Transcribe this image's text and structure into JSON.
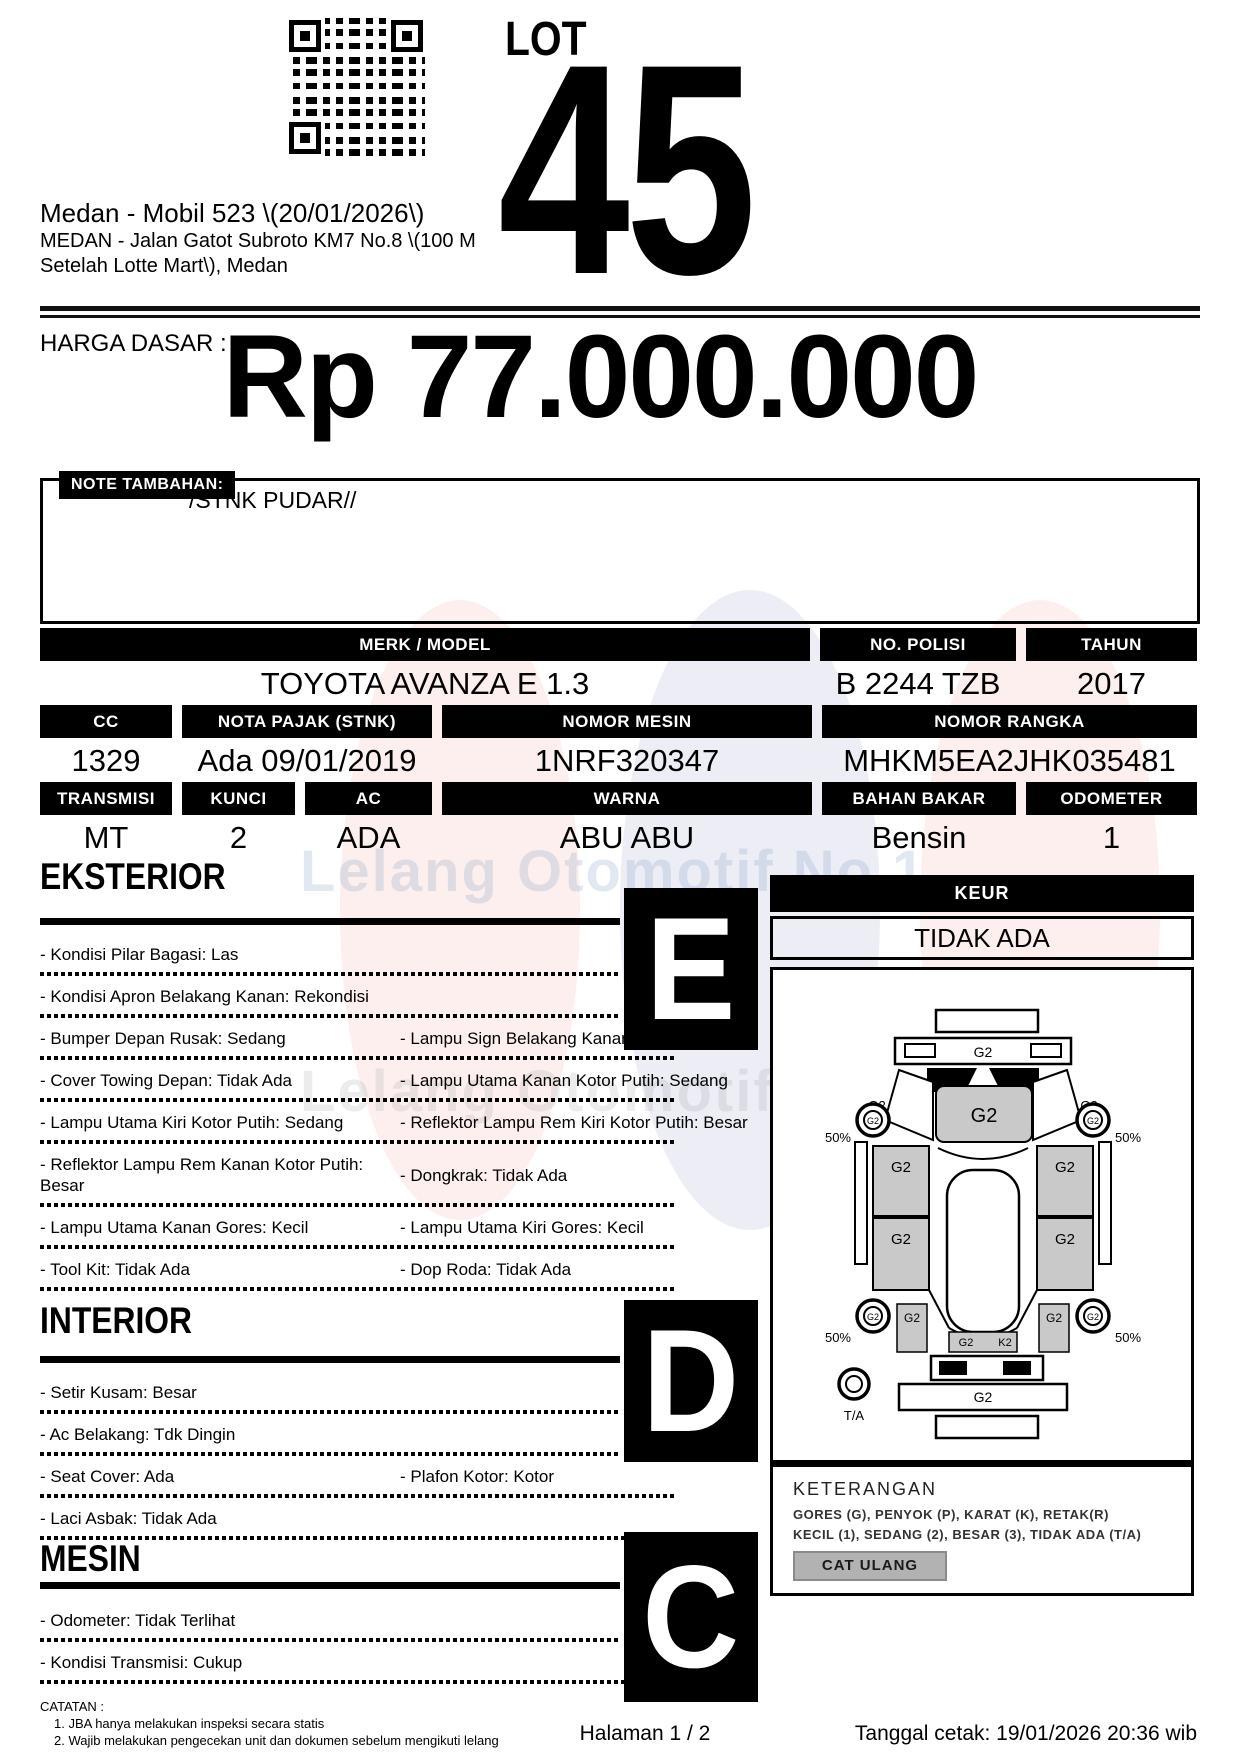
{
  "header": {
    "lot_label": "LOT",
    "lot_number": "45",
    "title": "Medan - Mobil 523 \\(20/01/2026\\)",
    "address_line1": "MEDAN - Jalan Gatot Subroto KM7 No.8 \\(100 M",
    "address_line2": "Setelah Lotte Mart\\), Medan"
  },
  "price": {
    "label": "HARGA DASAR :",
    "value": "Rp 77.000.000"
  },
  "note": {
    "label": "NOTE TAMBAHAN:",
    "text": "/STNK PUDAR//"
  },
  "specs": {
    "row1": [
      {
        "label": "MERK / MODEL",
        "value": "TOYOTA AVANZA E 1.3"
      },
      {
        "label": "NO. POLISI",
        "value": "B 2244 TZB"
      },
      {
        "label": "TAHUN",
        "value": "2017"
      }
    ],
    "row2": [
      {
        "label": "CC",
        "value": "1329"
      },
      {
        "label": "NOTA PAJAK (STNK)",
        "value": "Ada 09/01/2019"
      },
      {
        "label": "NOMOR MESIN",
        "value": "1NRF320347"
      },
      {
        "label": "NOMOR RANGKA",
        "value": "MHKM5EA2JHK035481"
      }
    ],
    "row3": [
      {
        "label": "TRANSMISI",
        "value": "MT"
      },
      {
        "label": "KUNCI",
        "value": "2"
      },
      {
        "label": "AC",
        "value": "ADA"
      },
      {
        "label": "WARNA",
        "value": "ABU ABU"
      },
      {
        "label": "BAHAN BAKAR",
        "value": "Bensin"
      },
      {
        "label": "ODOMETER",
        "value": "1"
      }
    ]
  },
  "eksterior": {
    "title": "EKSTERIOR",
    "grade": "E",
    "rows": [
      [
        "- Kondisi Pilar Bagasi: Las"
      ],
      [
        "- Kondisi Apron Belakang Kanan: Rekondisi"
      ],
      [
        "- Bumper Depan Rusak: Sedang",
        "- Lampu Sign Belakang Kanan: Pecah"
      ],
      [
        "- Cover Towing Depan: Tidak Ada",
        "- Lampu Utama Kanan Kotor Putih: Sedang"
      ],
      [
        "- Lampu Utama Kiri Kotor Putih: Sedang",
        "- Reflektor Lampu Rem Kiri Kotor Putih: Besar"
      ],
      [
        "- Reflektor Lampu Rem Kanan Kotor Putih: Besar",
        "- Dongkrak: Tidak Ada"
      ],
      [
        "- Lampu Utama Kanan Gores: Kecil",
        "- Lampu Utama Kiri Gores: Kecil"
      ],
      [
        "- Tool Kit: Tidak Ada",
        "- Dop Roda: Tidak Ada"
      ]
    ]
  },
  "interior": {
    "title": "INTERIOR",
    "grade": "D",
    "rows": [
      [
        "- Setir Kusam: Besar"
      ],
      [
        "- Ac Belakang: Tdk Dingin"
      ],
      [
        "- Seat Cover: Ada",
        "- Plafon Kotor: Kotor"
      ],
      [
        "- Laci Asbak: Tidak Ada"
      ]
    ]
  },
  "mesin": {
    "title": "MESIN",
    "grade": "C",
    "rows": [
      [
        "- Odometer: Tidak Terlihat"
      ],
      [
        "- Kondisi Transmisi: Cukup"
      ]
    ]
  },
  "keur": {
    "label": "KEUR",
    "value": "TIDAK ADA"
  },
  "diagram": {
    "panel_grade": "G2",
    "hood_grade": "K2",
    "tire_tread": "50%",
    "spare_tire": "T/A"
  },
  "keterangan": {
    "title": "KETERANGAN",
    "line1": "GORES (G), PENYOK (P), KARAT (K), RETAK(R)",
    "line2": "KECIL (1), SEDANG (2), BESAR (3), TIDAK ADA (T/A)",
    "repaint": "CAT ULANG"
  },
  "catatan": {
    "title": "CATATAN :",
    "item1": "1. JBA hanya melakukan inspeksi secara statis",
    "item2": "2. Wajib melakukan pengecekan unit dan dokumen sebelum mengikuti lelang"
  },
  "footer": {
    "page": "Halaman 1 / 2",
    "printed": "Tanggal cetak: 19/01/2026 20:36 wib"
  },
  "watermark": {
    "text": "Lelang Otomotif No.1"
  }
}
